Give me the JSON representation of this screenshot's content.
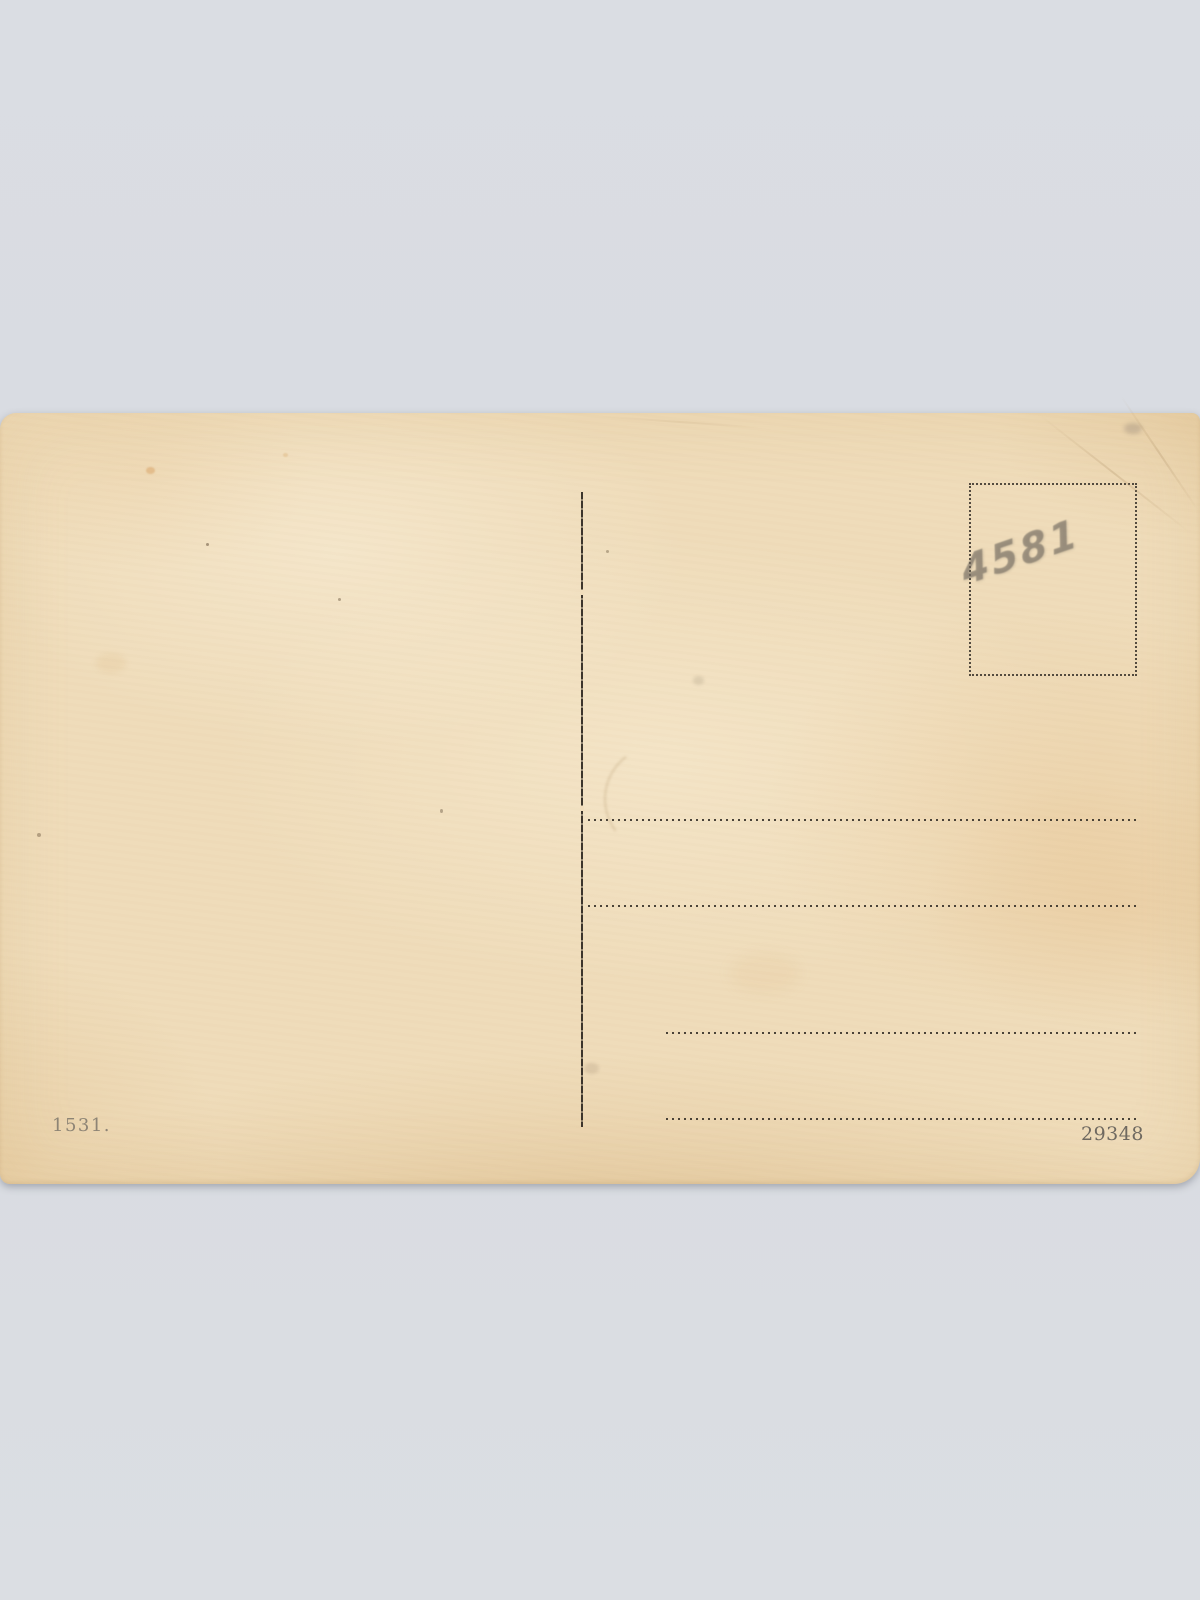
{
  "scene": {
    "type": "scanned vintage postcard back, blank",
    "background_color": "#d9dce2",
    "paper_color": "#efdcba",
    "ink_color": "#38322a",
    "pencil_color": "#766e63"
  },
  "postcard": {
    "handwritten_number": "4581",
    "printed_number_left": "1531.",
    "printed_number_right": "29348",
    "address_line_count": 4,
    "stamp_box_style": "dotted-outline"
  }
}
